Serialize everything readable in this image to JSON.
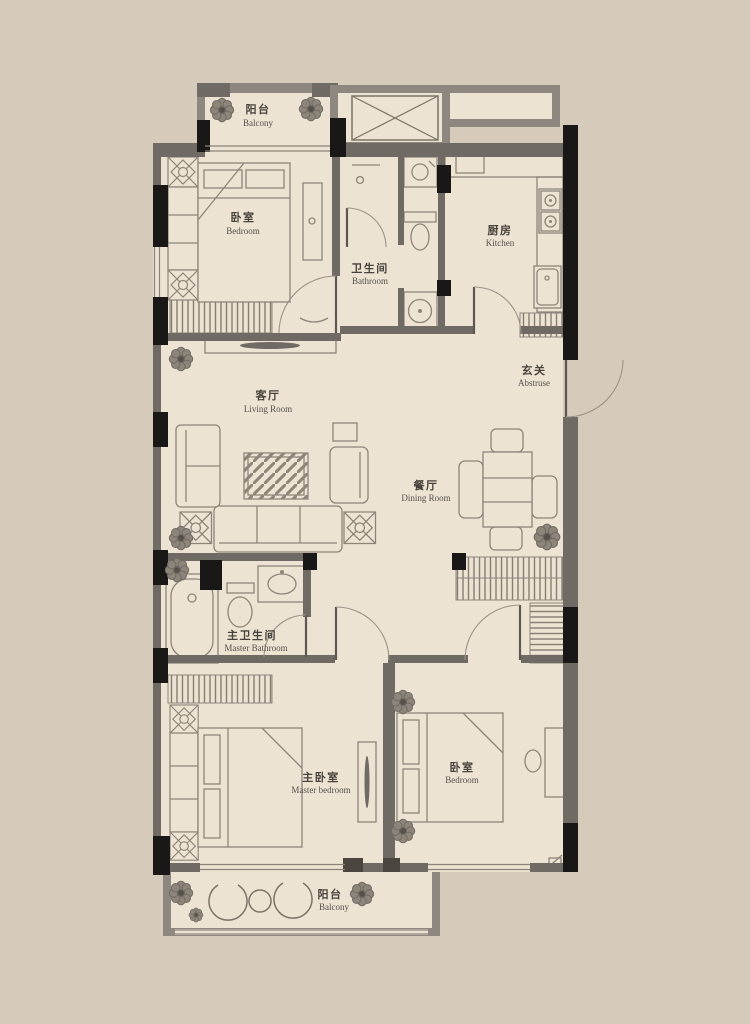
{
  "plan": {
    "rooms": {
      "balcony_top": {
        "label_zh": "阳台",
        "label_en": "Balcony"
      },
      "bedroom_top": {
        "label_zh": "卧室",
        "label_en": "Bedroom"
      },
      "bathroom": {
        "label_zh": "卫生间",
        "label_en": "Bathroom"
      },
      "kitchen": {
        "label_zh": "厨房",
        "label_en": "Kitchen"
      },
      "living_room": {
        "label_zh": "客厅",
        "label_en": "Living Room"
      },
      "entrance": {
        "label_zh": "玄关",
        "label_en": "Abstruse"
      },
      "dining_room": {
        "label_zh": "餐厅",
        "label_en": "Dining Room"
      },
      "master_bathroom": {
        "label_zh": "主卫生间",
        "label_en": "Master Bathroom"
      },
      "master_bedroom": {
        "label_zh": "主卧室",
        "label_en": "Master bedroom"
      },
      "bedroom_right": {
        "label_zh": "卧室",
        "label_en": "Bedroom"
      },
      "balcony_bottom": {
        "label_zh": "阳台",
        "label_en": "Balcony"
      }
    },
    "colors": {
      "background": "#d6cabb",
      "floor": "#ece3d2",
      "wall_gray": "#6f6a63",
      "wall_black": "#1a1817",
      "furniture_line": "#8d8579",
      "label_text": "#47423b"
    },
    "icons": [
      "flower-icon",
      "gear-icon",
      "elevator-x-icon",
      "door-arc-icon"
    ]
  }
}
